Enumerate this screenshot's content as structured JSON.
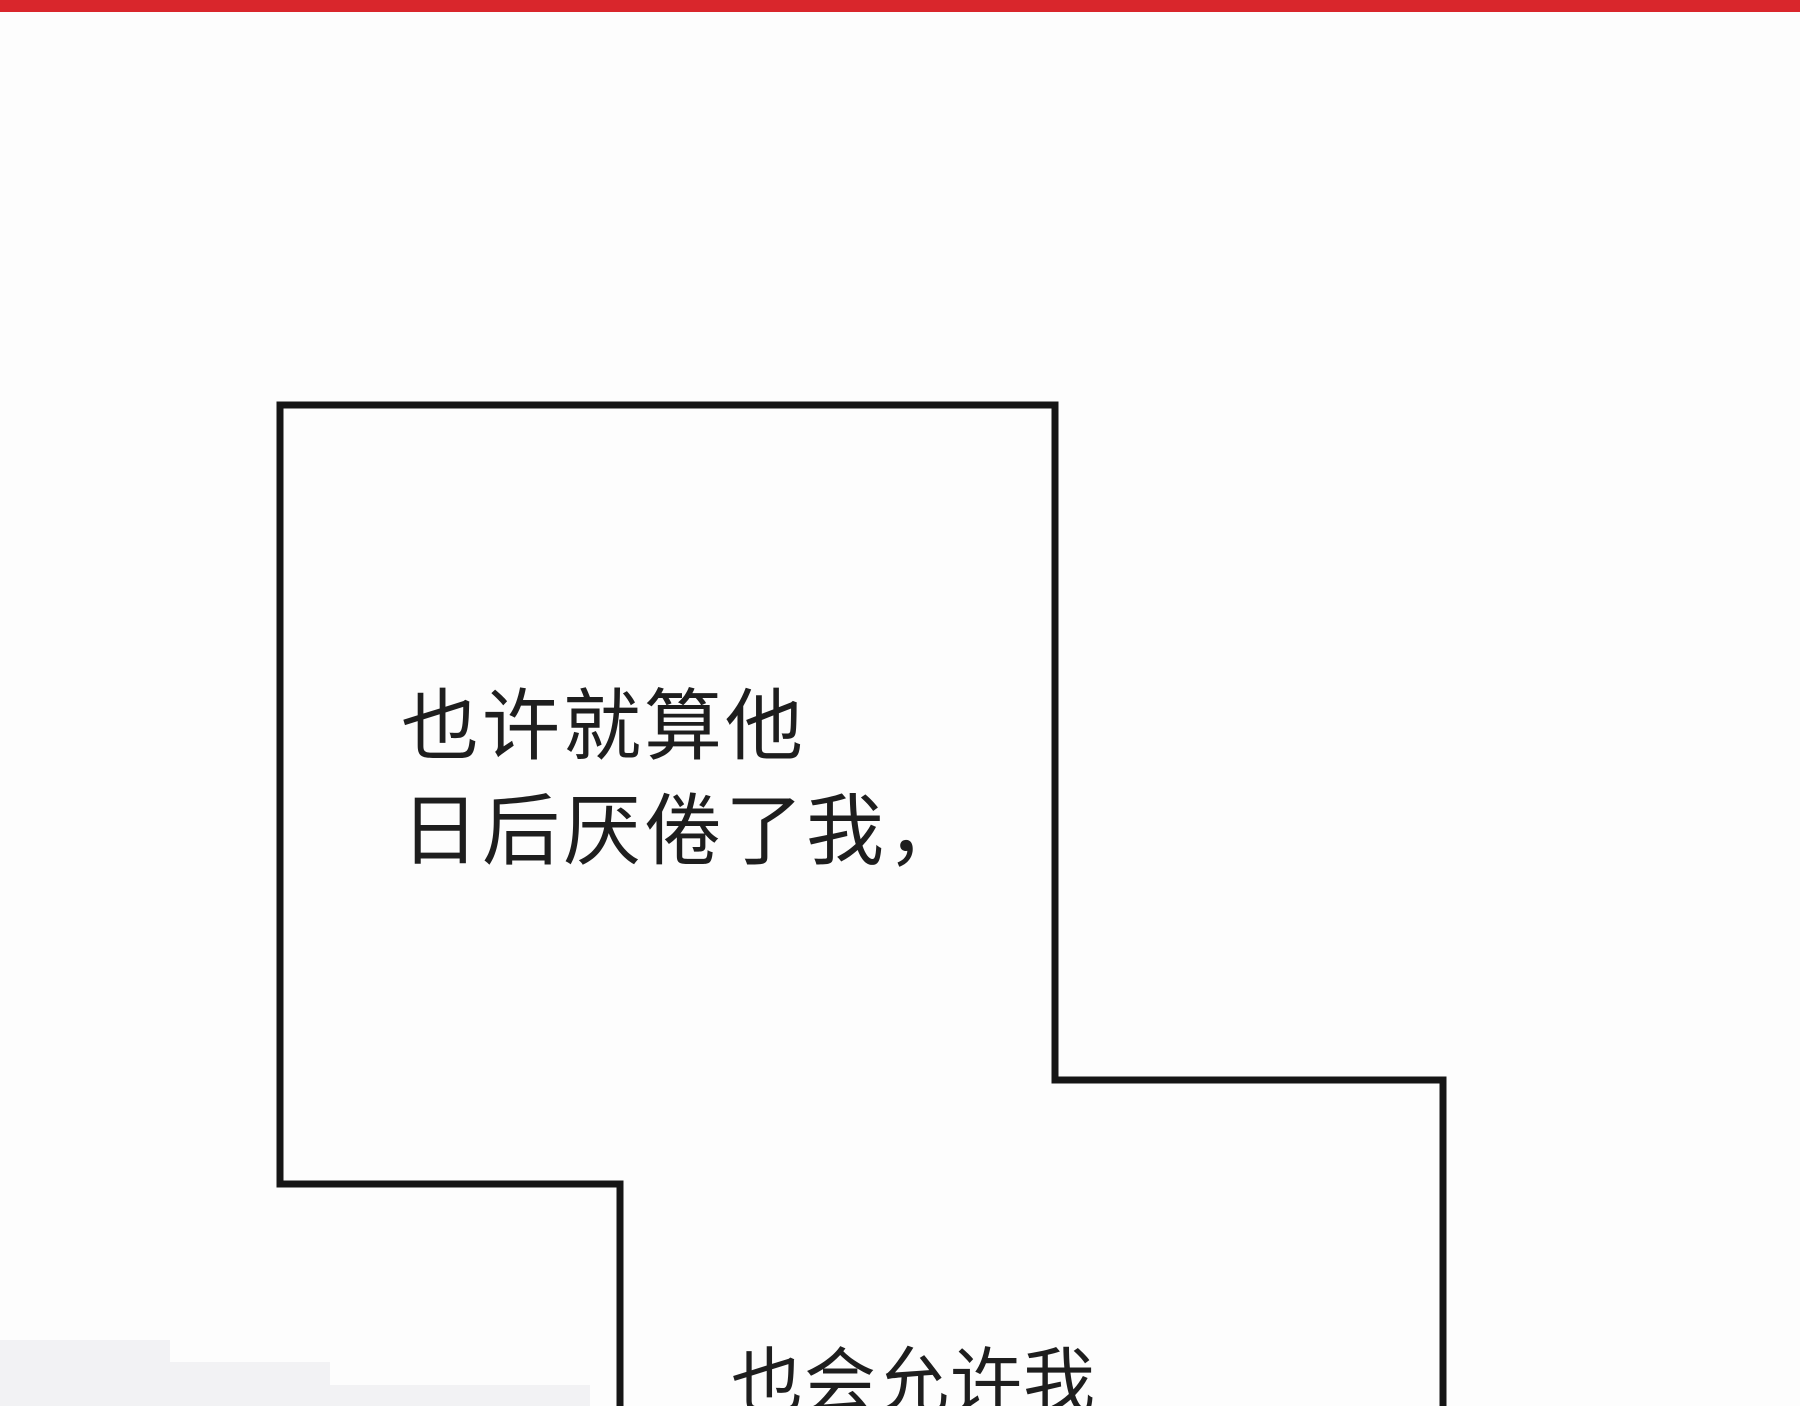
{
  "meta": {
    "content_type": "webtoon-comic-panel",
    "background_color": "#fdfdfd"
  },
  "top_strip": {
    "color": "#d9262c"
  },
  "panel": {
    "outline_color": "#161616",
    "outline_thickness_px": 7,
    "shading_color": "#f2f2f4"
  },
  "narration": {
    "line1": "也许就算他",
    "line2": "日后厌倦了我，",
    "bottom_line": "也会允许我"
  }
}
